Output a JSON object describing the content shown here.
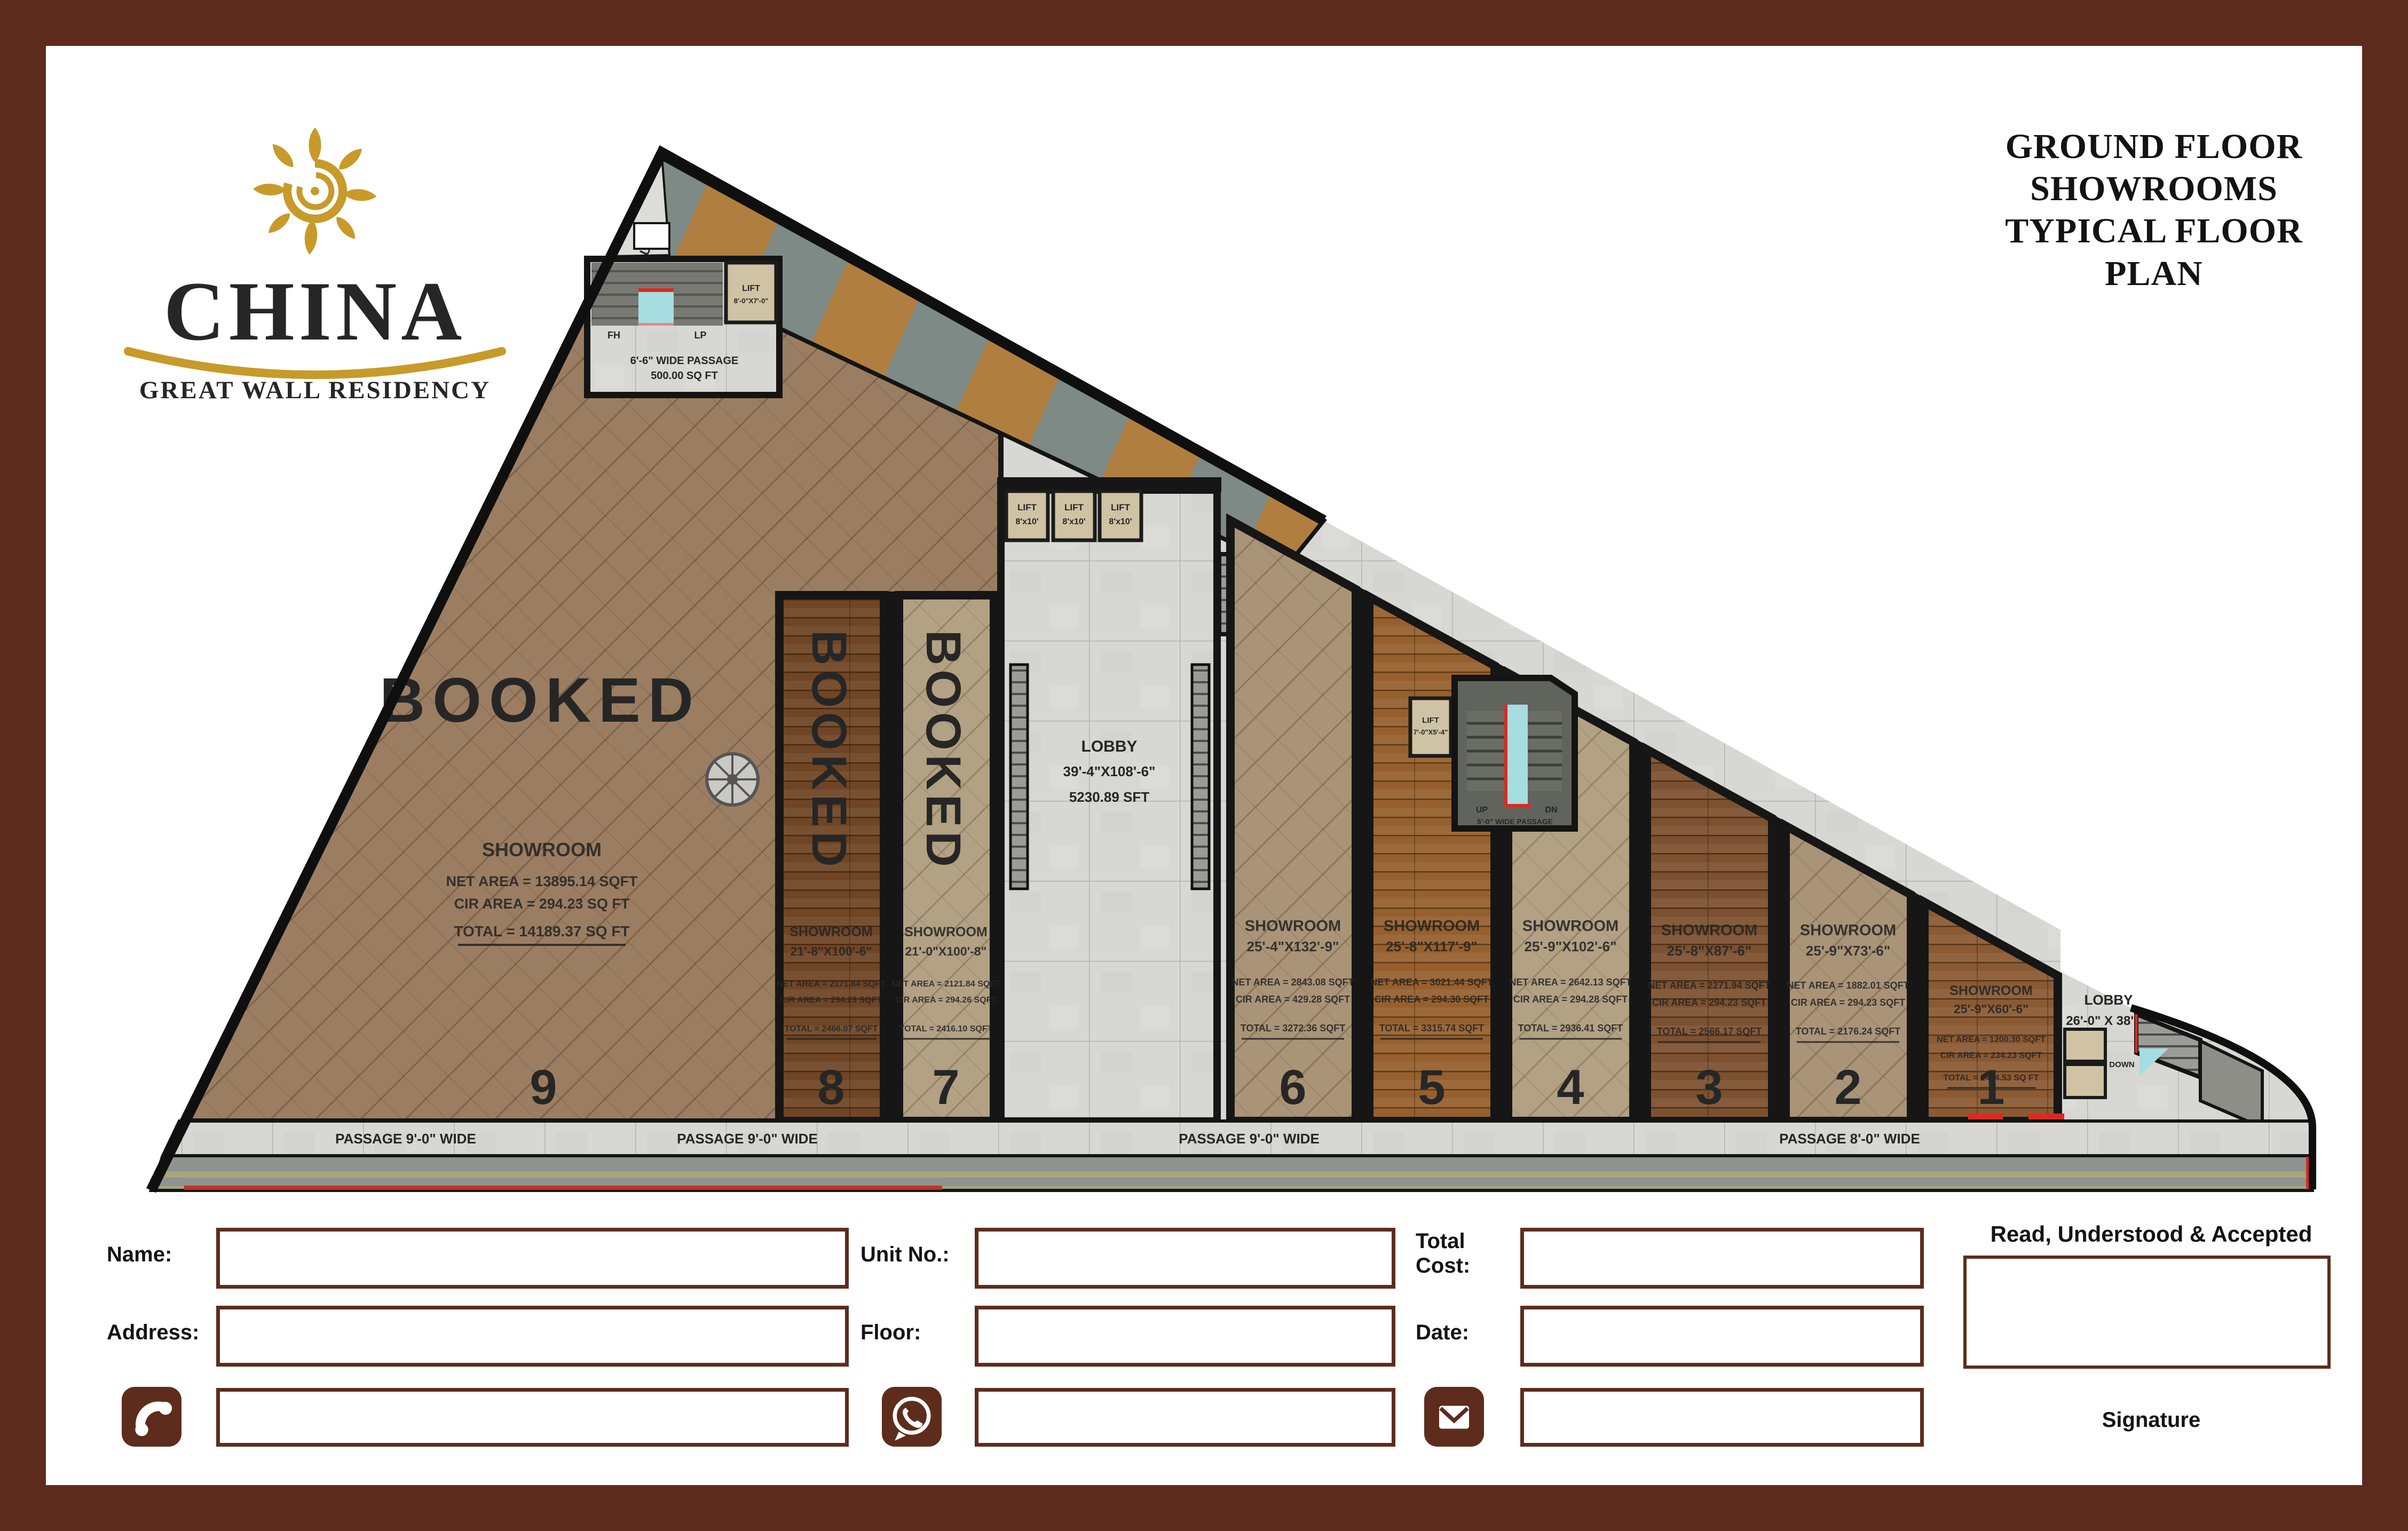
{
  "colors": {
    "frame_brown": "#5e2c1c",
    "logo_gold": "#c79a2a",
    "accent_red": "#d92b21",
    "cyan_stair": "#a5dde0",
    "concrete": "#d7d7d3"
  },
  "brand": {
    "name": "CHINA",
    "tagline": "GREAT WALL RESIDENCY"
  },
  "title": {
    "line1": "GROUND FLOOR",
    "line2": "SHOWROOMS",
    "line3": "TYPICAL FLOOR",
    "line4": "PLAN"
  },
  "plan": {
    "ramp_label": "RAMP UP",
    "entrance": {
      "lift_line1": "LIFT",
      "lift_line2": "8'-0\"X7'-0\"",
      "fh": "FH",
      "lp": "LP",
      "passage_line1": "6'-6\" WIDE PASSAGE",
      "passage_line2": "500.00 SQ FT"
    },
    "lifts": {
      "label": "LIFT",
      "size": "8'x10'"
    },
    "central_lobby": {
      "name": "LOBBY",
      "dims": "39'-4\"X108'-6\"",
      "area": "5230.89 SFT"
    },
    "mid_stair": {
      "lift_line1": "LIFT",
      "lift_line2": "7'-0\"X5'-4\"",
      "up": "UP",
      "dn": "DN",
      "passage": "5'-0\" WIDE PASSAGE"
    },
    "right_lobby": {
      "name": "LOBBY",
      "dims": "26'-0\" X 38'-0\"",
      "down": "DOWN"
    },
    "passages": {
      "p1": "PASSAGE 9'-0\" WIDE",
      "p2": "PASSAGE 9'-0\" WIDE",
      "p3": "PASSAGE 9'-0\" WIDE",
      "p4": "PASSAGE 8'-0\" WIDE"
    },
    "showrooms": [
      {
        "number": "9",
        "name": "SHOWROOM",
        "dims": "",
        "net": "NET AREA = 13895.14 SQFT",
        "cir": "CIR AREA = 294.23 SQ FT",
        "total": "TOTAL = 14189.37 SQ FT",
        "status": "BOOKED"
      },
      {
        "number": "8",
        "name": "SHOWROOM",
        "dims": "21'-8\"X100'-6\"",
        "net": "NET AREA = 2171.84 SQFT",
        "cir": "CIR AREA = 294.23 SQFT",
        "total": "TOTAL = 2466.07 SQFT",
        "status": "BOOKED"
      },
      {
        "number": "7",
        "name": "SHOWROOM",
        "dims": "21'-0\"X100'-8\"",
        "net": "NET AREA = 2121.84 SQFT",
        "cir": "CIR AREA = 294.26 SQFT",
        "total": "TOTAL = 2416.10 SQFT",
        "status": "BOOKED"
      },
      {
        "number": "6",
        "name": "SHOWROOM",
        "dims": "25'-4\"X132'-9\"",
        "net": "NET AREA = 2843.08 SQFT",
        "cir": "CIR AREA = 429.28 SQFT",
        "total": "TOTAL = 3272.36 SQFT",
        "status": ""
      },
      {
        "number": "5",
        "name": "SHOWROOM",
        "dims": "25'-8\"X117'-9\"",
        "net": "NET AREA = 3021.44 SQFT",
        "cir": "CIR AREA = 294.30 SQFT",
        "total": "TOTAL = 3315.74 SQFT",
        "status": ""
      },
      {
        "number": "4",
        "name": "SHOWROOM",
        "dims": "25'-9\"X102'-6\"",
        "net": "NET AREA = 2642.13 SQFT",
        "cir": "CIR AREA = 294.28 SQFT",
        "total": "TOTAL = 2936.41 SQFT",
        "status": ""
      },
      {
        "number": "3",
        "name": "SHOWROOM",
        "dims": "25'-8\"X87'-6\"",
        "net": "NET AREA = 2271.94 SQFT",
        "cir": "CIR AREA = 294.23 SQFT",
        "total": "TOTAL = 2566.17 SQFT",
        "status": ""
      },
      {
        "number": "2",
        "name": "SHOWROOM",
        "dims": "25'-9\"X73'-6\"",
        "net": "NET AREA = 1882.01 SQFT",
        "cir": "CIR AREA = 294.23 SQFT",
        "total": "TOTAL = 2176.24 SQFT",
        "status": ""
      },
      {
        "number": "1",
        "name": "SHOWROOM",
        "dims": "25'-9\"X60'-6\"",
        "net": "NET AREA = 1200.30 SQFT",
        "cir": "CIR AREA = 234.23 SQFT",
        "total": "TOTAL = 1434.53 SQ FT",
        "status": ""
      }
    ]
  },
  "form": {
    "name_label": "Name:",
    "address_label": "Address:",
    "unit_label": "Unit No.:",
    "floor_label": "Floor:",
    "total_cost_label": "Total Cost:",
    "date_label": "Date:",
    "accept_label": "Read, Understood & Accepted",
    "signature_label": "Signature"
  }
}
